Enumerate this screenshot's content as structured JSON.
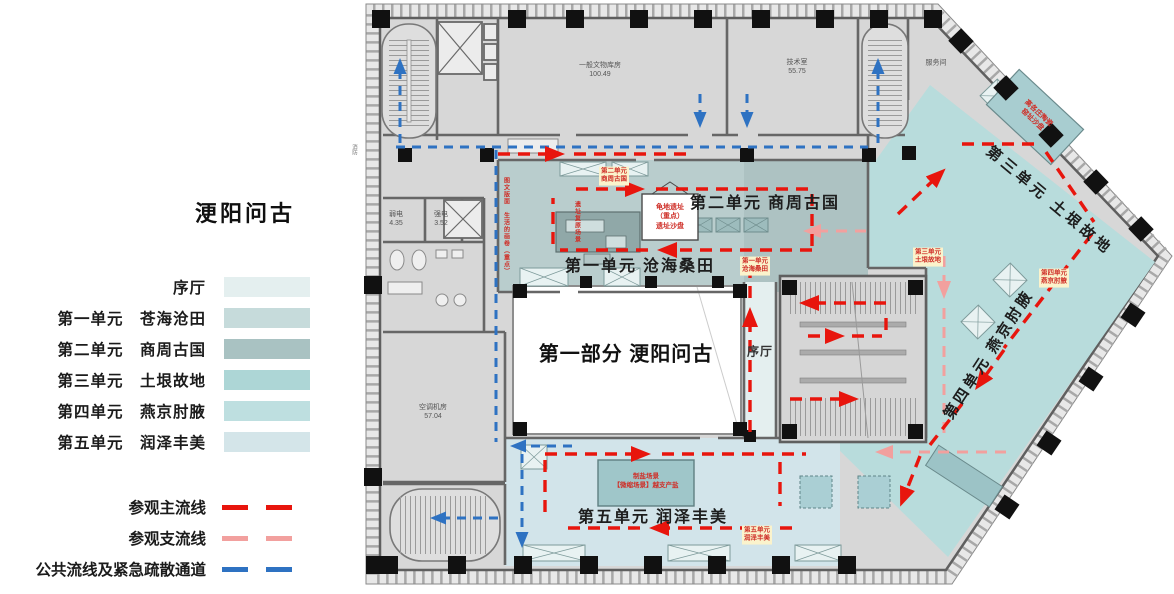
{
  "legend": {
    "title": "浭阳问古",
    "zones": [
      {
        "label": "序厅",
        "color": "#e4efef"
      },
      {
        "label": "第一单元　苍海沧田",
        "color": "#c6dbdb"
      },
      {
        "label": "第二单元　商周古国",
        "color": "#a9c2c2"
      },
      {
        "label": "第三单元　土垠故地",
        "color": "#add6d6"
      },
      {
        "label": "第四单元　燕京肘腋",
        "color": "#bedfe0"
      },
      {
        "label": "第五单元　润泽丰美",
        "color": "#d4e5e9"
      }
    ],
    "routes": [
      {
        "label": "参观主流线",
        "color": "#e8150d"
      },
      {
        "label": "参观支流线",
        "color": "#f2a09e"
      },
      {
        "label": "公共流线及紧急疏散通道",
        "color": "#2e72c2"
      }
    ]
  },
  "plan": {
    "part_title": "第一部分  浭阳问古",
    "hall": "序厅",
    "units": [
      "第一单元  沧海桑田",
      "第二单元  商周古国",
      "第三单元  土垠故地",
      "第四单元  燕京肘腋",
      "第五单元  润泽丰美"
    ],
    "rooms": [
      {
        "name": "一般文物库房",
        "area": "100.49"
      },
      {
        "name": "技术室",
        "area": "55.75"
      },
      {
        "name": "服务间",
        "area": ""
      },
      {
        "name": "弱电",
        "area": "4.35"
      },
      {
        "name": "强电",
        "area": "3.52"
      },
      {
        "name": "空调机房",
        "area": "57.04"
      },
      {
        "name": "消防",
        "area": ""
      }
    ],
    "tags": [
      {
        "line1": "第二单元",
        "line2": "商周古国"
      },
      {
        "line1": "第一单元",
        "line2": "沧海桑田"
      },
      {
        "line1": "第三单元",
        "line2": "土垠故地"
      },
      {
        "line1": "第四单元",
        "line2": "燕京肘腋"
      },
      {
        "line1": "第五单元",
        "line2": "润泽丰美"
      }
    ],
    "callouts": {
      "guidi": [
        "龟地遗址",
        "（重点）",
        "遗址沙盘"
      ],
      "zhiyan": [
        "制盐场景",
        "【微缩场景】越支产盐"
      ],
      "taoci": [
        "高各庄陶瓷",
        "窑址沙盘"
      ],
      "tuwen": "图文版面　生活的画卷（重点）",
      "yizhi": "遗址复原场景"
    },
    "colors": {
      "zone_a": "#b9cdcd",
      "zone_a2": "#adc2c2",
      "zone_b": "#b8dcdc",
      "zone_c": "#d2e4ea",
      "hall": "#e4efef",
      "wall": "#666666",
      "main_route": "#e8150d",
      "branch_route": "#f2a09e",
      "public_route": "#2e72c2",
      "tag_bg": "#fbf3cc",
      "callout_red": "#cf2f28"
    }
  }
}
